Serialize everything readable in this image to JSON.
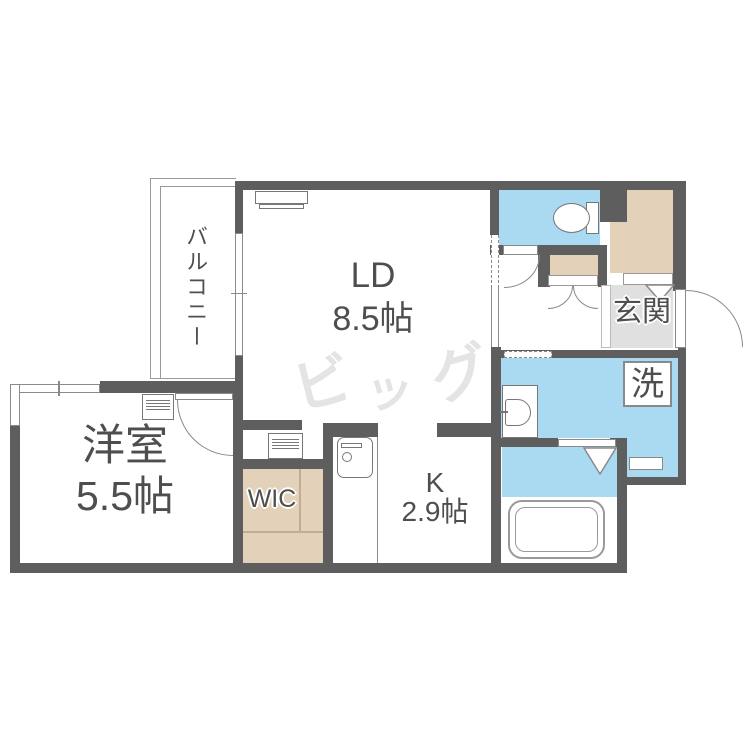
{
  "title": "1LDK間取り図",
  "colors": {
    "wall": "#5e5e5e",
    "line": "#8a8a8a",
    "water": "#a9daf2",
    "closet": "#e3d2b9",
    "entry": "#e0e0e0",
    "label": "#4e4e4e",
    "watermark": "#e4e4e4"
  },
  "rooms": {
    "balcony": {
      "label": "バルコニー"
    },
    "living_dining": {
      "label": "LD",
      "size": "8.5帖"
    },
    "western_room": {
      "label": "洋室",
      "size": "5.5帖"
    },
    "kitchen": {
      "label": "K",
      "size": "2.9帖"
    },
    "walk_in_closet": {
      "label": "WIC"
    },
    "entrance": {
      "label": "玄関"
    },
    "washer": {
      "label": "洗"
    }
  },
  "watermark": {
    "char1": "ビ",
    "char2": "ッ",
    "char3": "グ"
  }
}
